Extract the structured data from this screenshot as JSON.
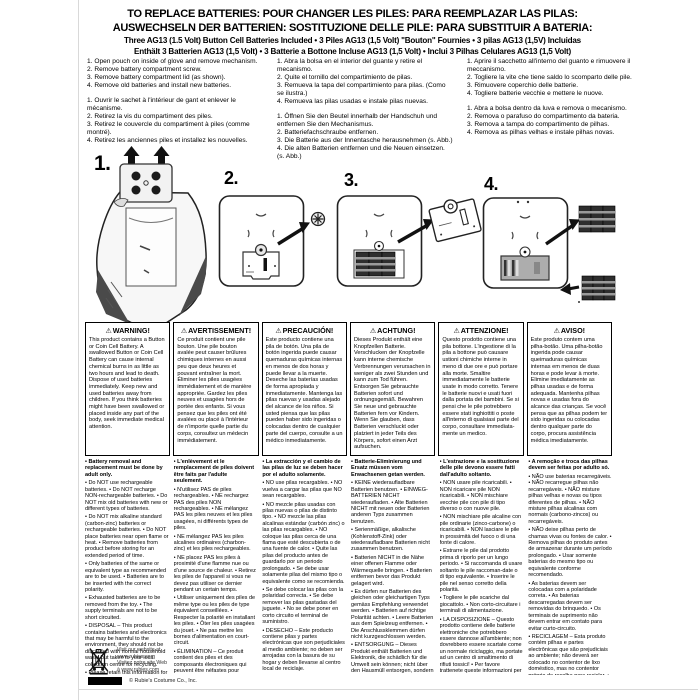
{
  "title": {
    "line1": "TO REPLACE BATTERIES: POUR CHANGER LES PILES: PARA REEMPLAZAR LAS PILAS:",
    "line2": "AUSWECHSELN DER BATTERIEN: SOSTITUZIONE DELLE PILE: PARA SUBSTITUIR A BATERIA:",
    "subtitle1": "Three AG13 (1.5 Volt) Button Cell Batteries Included • 3 Piles AG13 (1,5 Volt)  \"Bouton\" Fournies  • 3 pilas AG13 (1,5V) Incluidas",
    "subtitle2": "Enthält 3 Batterien AG13 (1,5 Volt) • 3 Batterie a Bottone Incluse AG13 (1,5 Volt) • Inclui 3 Pilhas Celulares AG13 (1,5 Volt)"
  },
  "steps": {
    "en": [
      "1. Open pouch on inside of glove and remove mechanism.",
      "2. Remove battery compartment screw.",
      "3. Remove battery compartment lid (as shown).",
      "4. Remove old batteries and install new batteries."
    ],
    "fr": [
      "1. Ouvrir le sachet à l'intérieur de gant et enlever le mécanisme.",
      "2. Retirez la vis du compartiment des piles.",
      "3. Retirez le couvercle du compartiment à piles (comme montré).",
      "4. Retirez les anciennes piles et installez les nouvelles."
    ],
    "es": [
      "1. Abra la bolsa en el interior del guante y retire el mecanismo.",
      "2. Quite el tornillo del compartimiento de pilas.",
      "3. Remueva la tapa del compartimiento para pilas. (Como se ilustra.)",
      "4. Remueva las pilas usadas e instale pilas nuevas."
    ],
    "de": [
      "1. Öffnen Sie den Beutel innerhalb der Handschuh und entfernen Sie den Mechanismus.",
      "2. Batteriefachschraube entfernen.",
      "3. Die Batterie aus der Innentasche herausnehmen (s. Abb.)",
      "4. Die alten Batterien entfernen und die Neuen einsetzen. (s. Abb.)"
    ],
    "it": [
      "1. Aprire il sacchetto all'interno del guanto e rimuovere il meccanismo.",
      "2. Togliere la vite che tiene saldo lo scomparto delle pile.",
      "3. Rimuovere coperchio delle batterie.",
      "4. Togliere batterie vecchie e mettere le nuove."
    ],
    "pt": [
      "1. Abra a bolsa dentro da luva e remova o mecanismo.",
      "2. Remova o parafuso do compartimento da bateria.",
      "3. Remova a tampa do compartimento de pilhas.",
      "4. Remova as pilhas velhas e instale pilhas novas."
    ]
  },
  "figure_labels": [
    "1.",
    "2.",
    "3.",
    "4."
  ],
  "warnings": [
    {
      "icon": "⚠",
      "title": "WARNING!",
      "text": "This product contains a Button or Coin Cell Battery. A swallowed Button or Coin Cell Battery can cause internal chemical burns in as little as two hours and lead to death. Dispose of used batteries immediately. Keep new and used batteries away from children. If you think batteries might have been swallowed or placed inside any part of the body, seek immediate medical attention."
    },
    {
      "icon": "⚠",
      "title": "AVERTISSEMENT!",
      "text": "Ce produit contient une pile bouton. Une pile bouton avalée peut causer brûlures chimiques internes en aussi peu que deux heures et pouvant entraîner la mort. Éliminer les piles usagées immédiatement et de manière appropriée. Gardez les piles neuves et usagées hors de portée des enfants. Si vous pensez que les piles ont été avalées ou placé à l'intérieur de n'importe quelle partie du corps, consultez un médecin immédiatement."
    },
    {
      "icon": "⚠",
      "title": "PRECAUCIÓN!",
      "text": "Este producto contiene una pila de botón. Una pila de botón ingerida puede causar quemaduras químicas internas en menos de dos horas y puede llevar a la muerte. Deseche las baterías usadas de forma apropiada y inmediatamente. Mantenga las pilas nuevas y usadas alejado del alcance de los niños. Si usted piensa que las pilas pueden haber sido ingeridas o colocadas dentro de cualquier parte del cuerpo, consulte a un médico inmediatamente."
    },
    {
      "icon": "⚠",
      "title": "ACHTUNG!",
      "text": "Dieses Produkt enthält eine Knopfzellen Batterie. Verschlucken der Knopfzelle kann interne chemische Verbrennungen verursachen in weniger als zwei Stunden und kann zum Tod führen. Entsorgen Sie gebrauchte Batterien sofort und ordnungsgemäß. Bewahren Sie neue und gebrauchte Batterien fern vor Kindern. Wenn Sie glauben, dass Batterien verschluckt oder platziert in jeder Teils des Körpers, sofort einen Arzt aufsuchen."
    },
    {
      "icon": "⚠",
      "title": "ATTENZIONE!",
      "text": "Questo prodotto contiene una pila bottone. L'ingestione di la pila a bottone può causare ustioni chimiche interne in meno di due ore e può portare alla morte. Smaltire immediatamente le batterie usate in modo corretto. Tenere le batterie nuovi e usati fuori dalla portata dei bambini. Se si pensi che le pile potrebbero essere stati inghiottiti o poste all'interno di qualsiasi parte del corpo, consultare immediata-mente un medico."
    },
    {
      "icon": "⚠",
      "title": "AVISO!",
      "text": "Este produto contem uma pilha-botão. Uma pilha-botão ingerida pode causar queimaduras químicas internas em menos de duas horas e pode levar à morte. Elimine imediatamente as pilhas usadas e de forma adequada. Mantenha pilhas novas e usadas fora do alcance das crianças. Se você pensa que as pilhas podem ter sido ingeridas ou colocadas dentro qualquer parte do corpo, procura assistência médica imediatamente."
    }
  ],
  "notes_columns": [
    [
      "• Battery removal and replacement must be done by adult only.",
      "• Do NOT use rechargeable batteries. • Do NOT recharge NON-rechargeable batteries. • Do NOT mix old batteries with new or different types of batteries.",
      "• Do NOT mix alkaline standard (carbon-zinc) batteries or rechargeable batteries. • Do NOT place batteries near open flame or heat. • Remove batteries from product before storing for an extended period of time.",
      "• Only batteries of the same or equivalent type as recommended are to be used. • Batteries are to be inserted with the correct polarity.",
      "• Exhausted batteries are to be removed from the toy. • The supply terminals are not to be short circuited.",
      "• DISPOSAL – This product contains batteries and electronics that may be harmful to the environment, they should not be discarded with normal household waste but taken to your local collection centre for recycling.",
      "• Please retain this information for future reference."
    ],
    [
      "• L'enlèvement et le remplacement de piles doivent être faits par l'adulte seulement.",
      "• N'utilisez PAS de piles rechargeables. • NE rechargez PAS des piles NON rechargeables. • NE mélangez PAS les piles neuves et les piles usagées, ni différents types de piles.",
      "• NE mélangez PAS les piles alcalines ordinaires (charbon-zinc) et les piles rechargeables.",
      "• NE placez PAS les piles à proximité d'une flamme nue ou d'une source de chaleur. • Retirez les piles de l'appareil si vous ne devez pas utiliser ce dernier pendant un certain temps.",
      "• Utiliser uniquement des piles de même type ou les piles de type équivalent conseillées. • Respecter la polarité en installant les piles. • Ôter les piles usagées du jouet. • Ne pas mettre les bornes d'alimentation en court-circuit.",
      "• ÉLIMINATION – Ce produit contient des piles et des composants électroniques qui peuvent être néfastes pour l'environnement; il ne doit pas être jeté avec les ordures ménagères mais doit être porté au centre de tri des ordures pour être recyclé. • Garder des informations pour consultation ultérieure."
    ],
    [
      "• La extracción y el cambio de las pilas de luz se deben hacer por el adulto solamente.",
      "• NO use pilas recargables. • NO vuelva a cargar las pilas que NO sean recargables.",
      "• NO mezcle pilas usadas con pilas nuevas o pilas de distinto tipo. • NO mezcle las pilas alcalinas estándar (carbón zinc) o las pilas recargables. • NO coloque las pilas cerca de una flama que esté descubierta o de una fuente de calor. • Quite las pilas del producto antes de guardarlo por un periodo prolongado. • Se debe usar solamente pilas del mismo tipo o equivalente como se recomienda.",
      "• Se debe colocar las pilas con la polaridad correcta. • Se debe remover las pilas gastadas del juguete. • No se debe poner en corto circuito el terminal de suministro.",
      "• DESECHO – Este producto contiene pilas y partes electrónicas que son perjudiciales al medio ambiente; no deben ser arrojadas con la basura de su hogar y deben llevarse al centro local de reciclaje.",
      "• Favor mantenga esta información para referencia futura."
    ],
    [
      "• Batterie-Eliminierung und Ersatz müssen vom Erwachsenen getan werden.",
      "• KEINE wiederaufladbare Batterien benutzen. • EINWEG-BATTERIEN NICHT wiederaufladen. • Alte Batterien NICHT mit neuen oder Batterien anderen Typs zusammen benutzen.",
      "• Serienmäßige, alkalische (Kohlenstoff-Zink) oder wiederaufladbare Batterien nicht zusammen benutzen.",
      "• Batterien NICHT in die Nähe einer offenen Flamme oder Wärmequelle bringen. • Batterien entfernen bevor das Produkt gelagert wird.",
      "• Es dürfen nur Batterien des gleichen oder gleichartigen Typs gemäss Empfehlung verwendet werden. • Batterien auf richtige Polarität achten. • Leere Batterien aus dem Spielzeug entfernen. • Die Anschlussklemmen dürfen nicht kurzgeschlossen werden.",
      "• ENTSORGUNG – Dieses Produkt enthält Batterien und Elektronik, die schädlich für die Umwelt sein können; nicht über den Hausmüll entsorgen, sondern bei den örtlichen Sammelstellen abgeben. • Diese Informationen für künftige Referenz aufbewahren."
    ],
    [
      "• L'estrazione e la sostituzione delle pile devono essere fatti dall'adulto soltanto.",
      "• NON usare pile ricaricabili. • NON ricaricare pile NON ricaricabili. • NON mischiare vecchie pile con pile di tipo diverso o con nuove pile.",
      "• NON mischiare pile alcaline con pile ordinarie (zinco-carbone) o ricaricabili. • NON lasciare le pile in prossimità del fuoco o di una fonte di calore.",
      "• Estrarre le pile dal prodotto prima di riporlo per un lungo periodo. • Si raccomanda di usare soltanto le pile raccoman-date o di tipo equivalente. • Inserire le pile nel senso corretto della polarità.",
      "• Togliere le pile scariche dal giocattolo. • Non corto-circuitare i terminali di alimentazione.",
      "• LA DISPOSIZIONE – Questo prodotto contiene delle batterie elettroniche che potrebbero essere dannose all'ambiente; non dovrebbero essere scartate come un normale riciclaggio, ma portate ad un centro di smaltimento di rifiuti tossici! • Per favore trattenete queste informazioni per un prossimo futuro."
    ],
    [
      "• A remoção e troca das pilhas devem ser feitas por adulto só.",
      "• NÃO use baterias recarregáveis. • NÃO recarregue pilhas não recarregáveis. • NÃO misture pilhas velhas e novas ou tipos diferentes de pilhas. • NÃO misture pilhas alcalinas com normais (carbono-zincos) ou recarregáveis.",
      "• NÃO deixe pilhas perto de chamas vivas ou fontes de calor. • Remova pilhas do produto antes de armazenar durante um período prolongado. • Usar somente baterias do mesmo tipo ou equivalente conforme recomendado.",
      "• As baterias devem ser colocadas com a polaridade correta. • As baterias descarregadas devem ser removidas do brinquedo. • Os terminais de suprimento não devem entrar em contato para evitar curto-circuito.",
      "• RECICLAGEM – Esta produto contém pilhas e partes electrônicas que são prejudiciais ao ambiente; não deverá ser colocado no contentor de lixo doméstico, mas no contentor próprio de recolha para reciclar. • Por favor guarde esta informação para futura referência."
    ]
  ],
  "footer": {
    "website_lines": [
      "Visit our website at",
      "www.rubies.com",
      "Visitez notre site Web",
      "à www.rubies.com"
    ],
    "copyright": "© Rubie's Costume Co., Inc."
  }
}
